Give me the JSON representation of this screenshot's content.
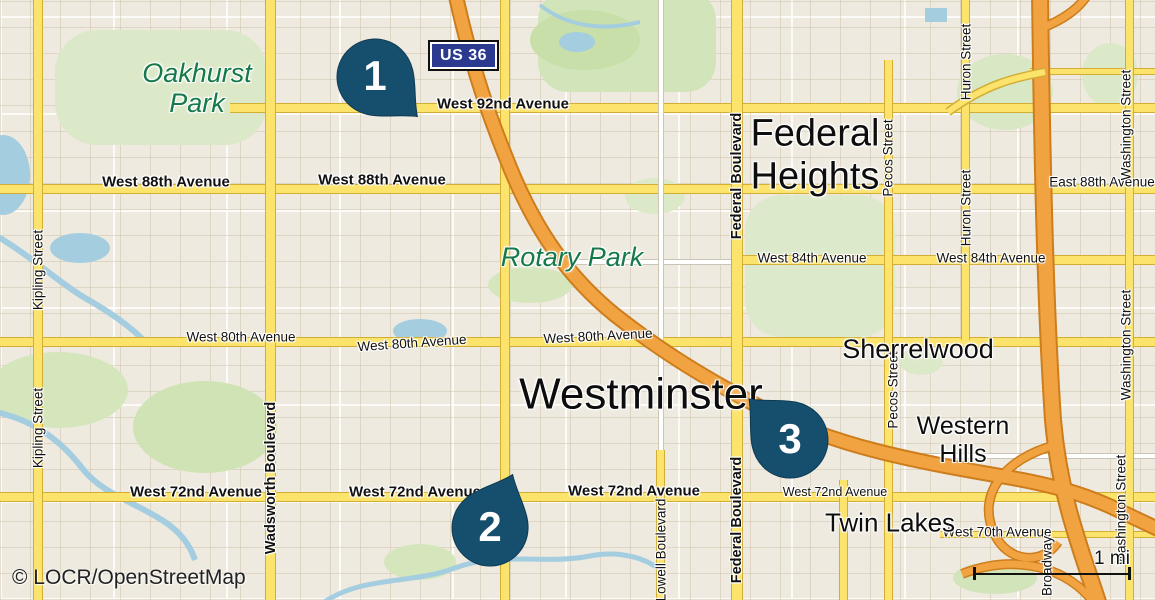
{
  "attribution": "© LOCR/OpenStreetMap",
  "scale": {
    "label": "1 mi"
  },
  "highway_shield": {
    "label": "US 36"
  },
  "markers": {
    "pin1": "1",
    "pin2": "2",
    "pin3": "3"
  },
  "places": {
    "oakhurst_park": "Oakhurst Park",
    "rotary_park": "Rotary Park",
    "federal_heights": "Federal Heights",
    "westminster": "Westminster",
    "sherrelwood": "Sherrelwood",
    "western_hills": "Western Hills",
    "twin_lakes": "Twin Lakes"
  },
  "streets": {
    "west_92nd": "West 92nd Avenue",
    "west_88th": "West 88th Avenue",
    "east_88th": "East 88th Avenue",
    "west_84th": "West 84th Avenue",
    "west_80th": "West 80th Avenue",
    "west_72nd": "West 72nd Avenue",
    "west_70th": "West 70th Avenue",
    "kipling": "Kipling Street",
    "wadsworth": "Wadsworth Boulevard",
    "lowell": "Lowell Boulevard",
    "federal": "Federal Boulevard",
    "pecos": "Pecos Street",
    "huron": "Huron Street",
    "washington": "Washington Street",
    "broadway": "Broadway"
  },
  "colors": {
    "pin": "#164f6e",
    "shield_bg": "#2b3a8e",
    "road_yellow": "#fce36c",
    "motorway_orange": "#f2a341",
    "water": "#a5cde0",
    "park_green": "#d8e8c2",
    "park_label_green": "#15794a"
  }
}
